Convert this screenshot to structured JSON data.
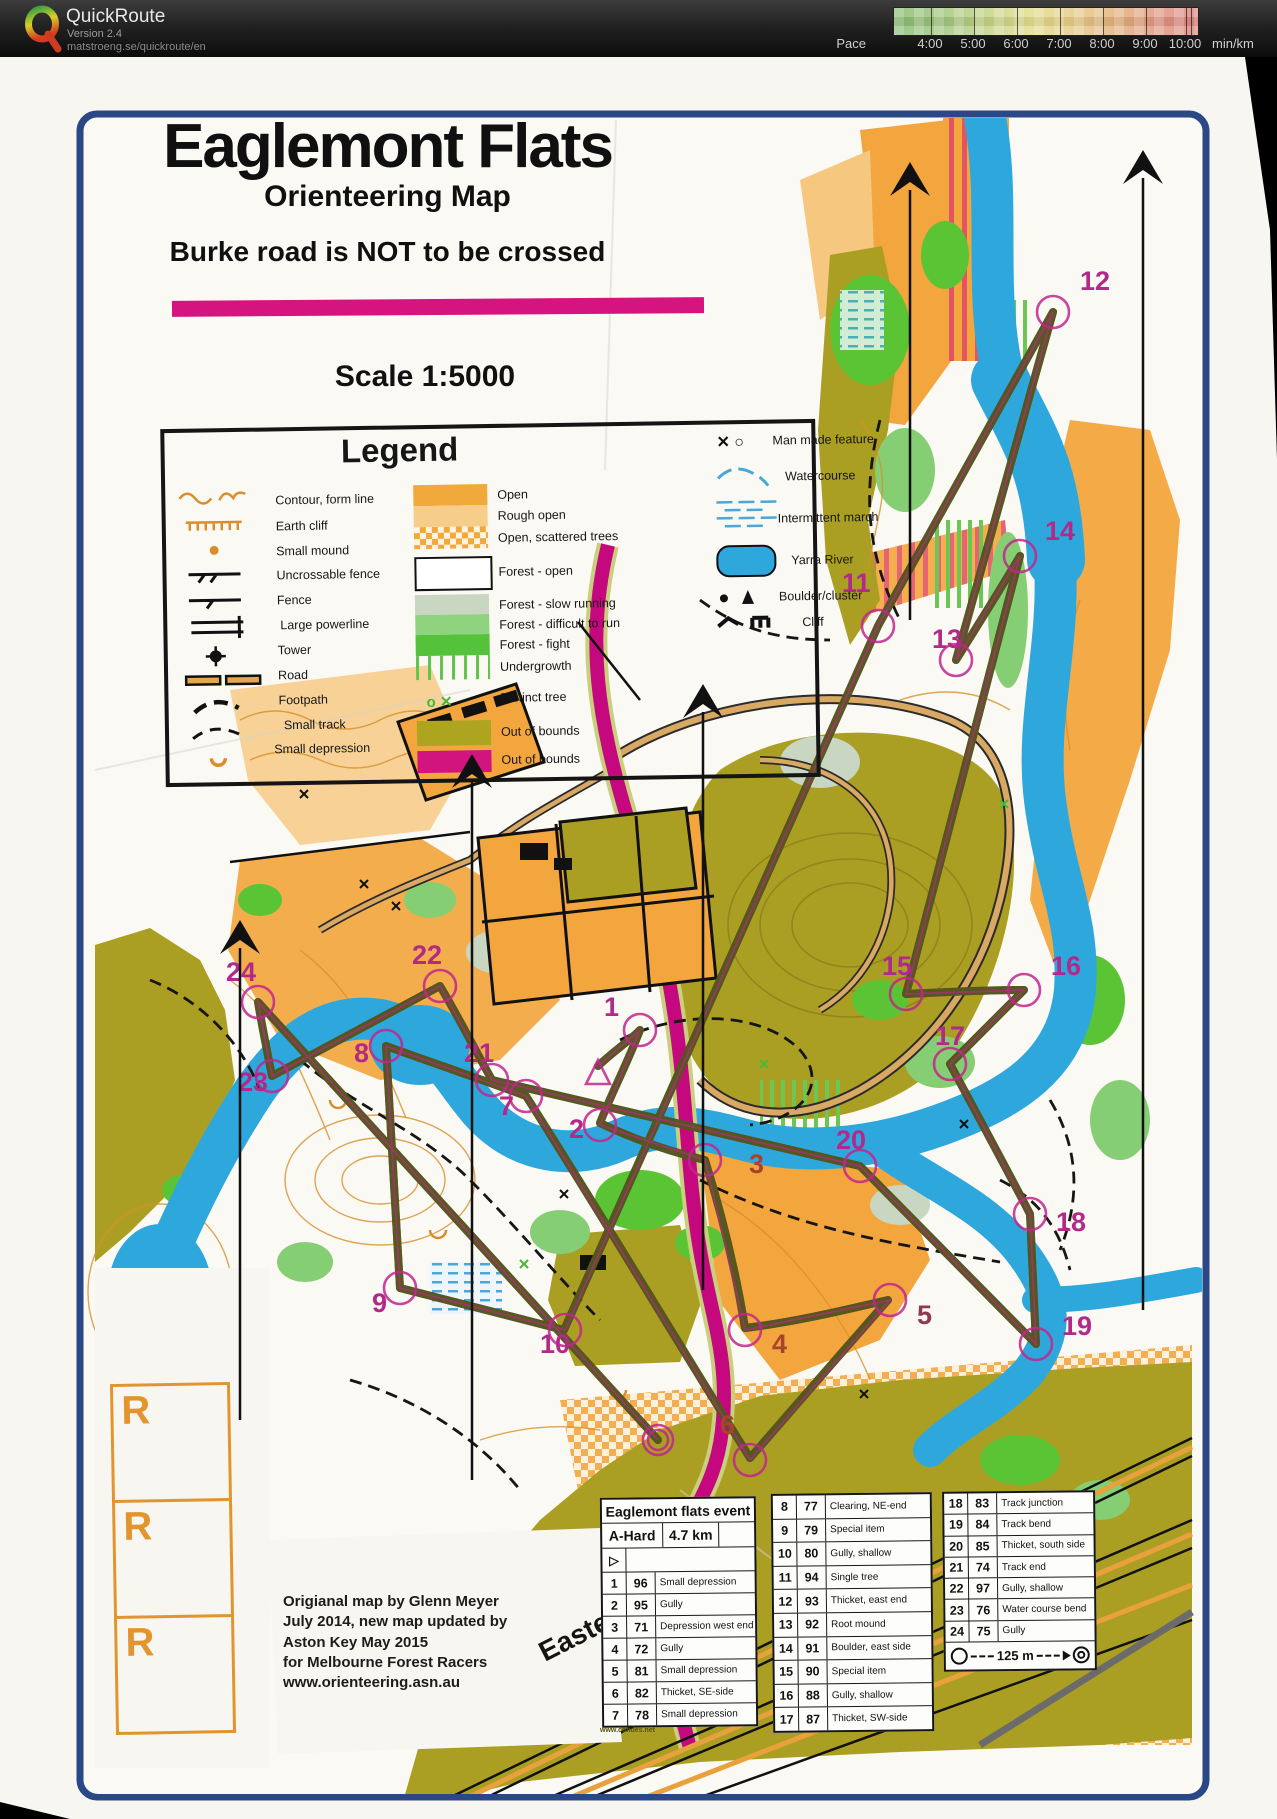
{
  "app": {
    "name": "QuickRoute",
    "version": "Version 2.4",
    "url": "matstroeng.se/quickroute/en",
    "pace": {
      "label": "Pace",
      "ticks": [
        "4:00",
        "5:00",
        "6:00",
        "7:00",
        "8:00",
        "9:00",
        "10:00"
      ],
      "unit": "min/km",
      "gradient_colors": [
        "#8abb72",
        "#e2dd8d",
        "#de8781"
      ]
    }
  },
  "map": {
    "title": "Eaglemont Flats",
    "subtitle": "Orienteering Map",
    "warning": "Burke road is NOT to be crossed",
    "scale": "Scale 1:5000",
    "road_label": "Eastern",
    "margin_letter": "R",
    "accent_magenta": "#d6147f",
    "out_of_bounds_olive": "#ab9f23",
    "river_blue": "#2ea8dc",
    "open_orange": "#f3a63d",
    "legend": {
      "title": "Legend",
      "line_items": [
        "Contour, form line",
        "Earth cliff",
        "Small mound",
        "Uncrossable fence",
        "Fence",
        "Large powerline",
        "Tower",
        "Road",
        "Footpath",
        "Small track",
        "Small depression"
      ],
      "area_items": [
        "Open",
        "Rough open",
        "Open, scattered trees",
        "Forest - open",
        "Forest - slow running",
        "Forest - difficult to run",
        "Forest - fight",
        "Undergrowth",
        "Distinct tree",
        "Out of bounds",
        "Out of bounds"
      ],
      "water_items": [
        "Man made feature",
        "Watercourse",
        "Intermittent march",
        "Yarra River",
        "Boulder/cluster",
        "Cliff"
      ]
    },
    "credits": [
      "Origianal map by Glenn Meyer",
      "July 2014, new map updated by",
      "Aston Key May 2015",
      "for Melbourne Forest Racers",
      "www.orienteering.asn.au"
    ]
  },
  "course": {
    "event": "Eaglemont flats event",
    "class": "A-Hard",
    "length": "4.7 km",
    "scale_bar": "125 m",
    "fine_print": "www.condes.net",
    "controls": [
      {
        "n": "1",
        "code": "96",
        "desc": "Small depression"
      },
      {
        "n": "2",
        "code": "95",
        "desc": "Gully"
      },
      {
        "n": "3",
        "code": "71",
        "desc": "Depression west end"
      },
      {
        "n": "4",
        "code": "72",
        "desc": "Gully"
      },
      {
        "n": "5",
        "code": "81",
        "desc": "Small depression"
      },
      {
        "n": "6",
        "code": "82",
        "desc": "Thicket, SE-side"
      },
      {
        "n": "7",
        "code": "78",
        "desc": "Small depression"
      },
      {
        "n": "8",
        "code": "77",
        "desc": "Clearing, NE-end"
      },
      {
        "n": "9",
        "code": "79",
        "desc": "Special item"
      },
      {
        "n": "10",
        "code": "80",
        "desc": "Gully, shallow"
      },
      {
        "n": "11",
        "code": "94",
        "desc": "Single tree"
      },
      {
        "n": "12",
        "code": "93",
        "desc": "Thicket, east end"
      },
      {
        "n": "13",
        "code": "92",
        "desc": "Root mound"
      },
      {
        "n": "14",
        "code": "91",
        "desc": "Boulder, east side"
      },
      {
        "n": "15",
        "code": "90",
        "desc": "Special item"
      },
      {
        "n": "16",
        "code": "88",
        "desc": "Gully, shallow"
      },
      {
        "n": "17",
        "code": "87",
        "desc": "Thicket, SW-side"
      },
      {
        "n": "18",
        "code": "83",
        "desc": "Track junction"
      },
      {
        "n": "19",
        "code": "84",
        "desc": "Track bend"
      },
      {
        "n": "20",
        "code": "85",
        "desc": "Thicket, south side"
      },
      {
        "n": "21",
        "code": "74",
        "desc": "Track end"
      },
      {
        "n": "22",
        "code": "97",
        "desc": "Gully, shallow"
      },
      {
        "n": "23",
        "code": "76",
        "desc": "Water course bend"
      },
      {
        "n": "24",
        "code": "75",
        "desc": "Gully"
      }
    ]
  }
}
